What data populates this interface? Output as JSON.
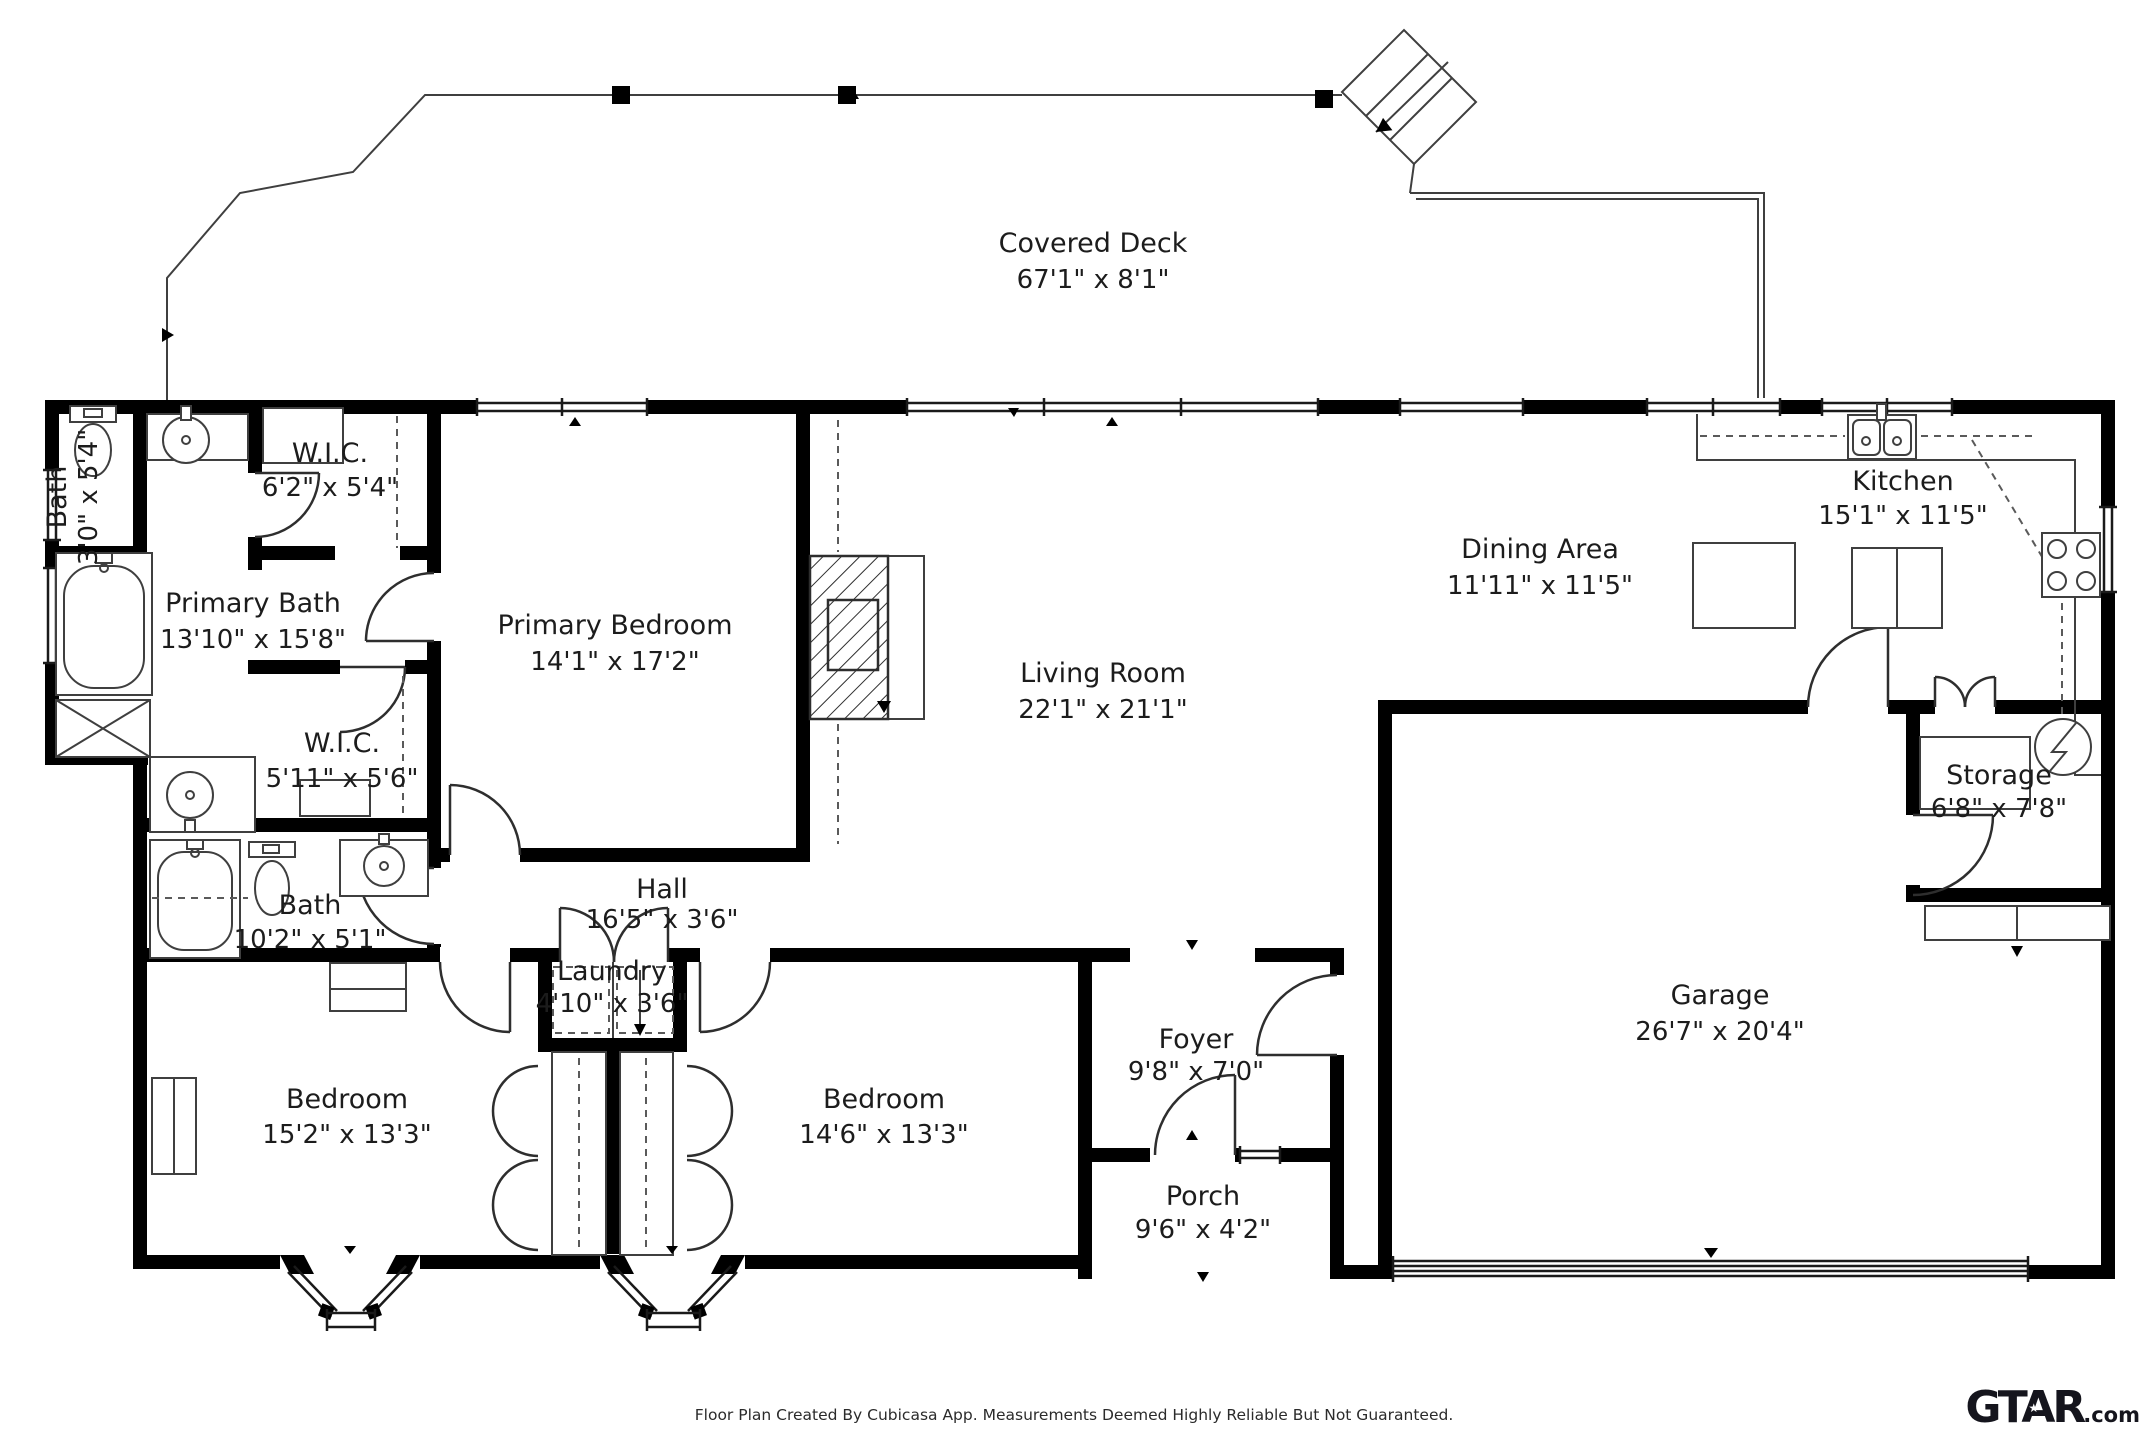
{
  "colors": {
    "wall": "#000000",
    "line": "#3f3f3f",
    "text": "#1c1c1c",
    "background": "#ffffff"
  },
  "rooms": [
    {
      "name": "Covered Deck",
      "dims": "67'1\" x 8'1\""
    },
    {
      "name": "Bath",
      "dims": "3'0\" x 5'4\""
    },
    {
      "name": "W.I.C.",
      "dims": "6'2\" x 5'4\""
    },
    {
      "name": "Primary Bath",
      "dims": "13'10\" x 15'8\""
    },
    {
      "name": "Primary Bedroom",
      "dims": "14'1\" x 17'2\""
    },
    {
      "name": "W.I.C.",
      "dims": "5'11\" x 5'6\""
    },
    {
      "name": "Bath",
      "dims": "10'2\" x 5'1\""
    },
    {
      "name": "Hall",
      "dims": "16'5\" x 3'6\""
    },
    {
      "name": "Living Room",
      "dims": "22'1\" x 21'1\""
    },
    {
      "name": "Dining Area",
      "dims": "11'11\" x 11'5\""
    },
    {
      "name": "Kitchen",
      "dims": "15'1\" x 11'5\""
    },
    {
      "name": "Storage",
      "dims": "6'8\" x 7'8\""
    },
    {
      "name": "Garage",
      "dims": "26'7\" x 20'4\""
    },
    {
      "name": "Laundry",
      "dims": "4'10\" x 3'6\""
    },
    {
      "name": "Bedroom",
      "dims": "15'2\" x 13'3\""
    },
    {
      "name": "Bedroom",
      "dims": "14'6\" x 13'3\""
    },
    {
      "name": "Foyer",
      "dims": "9'8\" x 7'0\""
    },
    {
      "name": "Porch",
      "dims": "9'6\" x 4'2\""
    }
  ],
  "fixtures": [
    "toilet-icon",
    "pedestal-sink-icon",
    "bathtub-icon",
    "shower-icon",
    "vanity-sink-icon",
    "double-sink-icon",
    "stove-icon",
    "refrigerator-icon",
    "kitchen-island-icon",
    "washer-dryer-icon",
    "water-heater-icon",
    "fireplace-icon",
    "stairs-icon",
    "closet-rod-icon",
    "shelf-icon",
    "dresser-icon",
    "bay-window-icon",
    "garage-door-icon"
  ],
  "footer": {
    "disclaimer": "Floor Plan Created By Cubicasa App. Measurements Deemed Highly Reliable But Not Guaranteed.",
    "logo_main": "GTAR",
    "logo_star": "★",
    "logo_suffix": ".com"
  }
}
